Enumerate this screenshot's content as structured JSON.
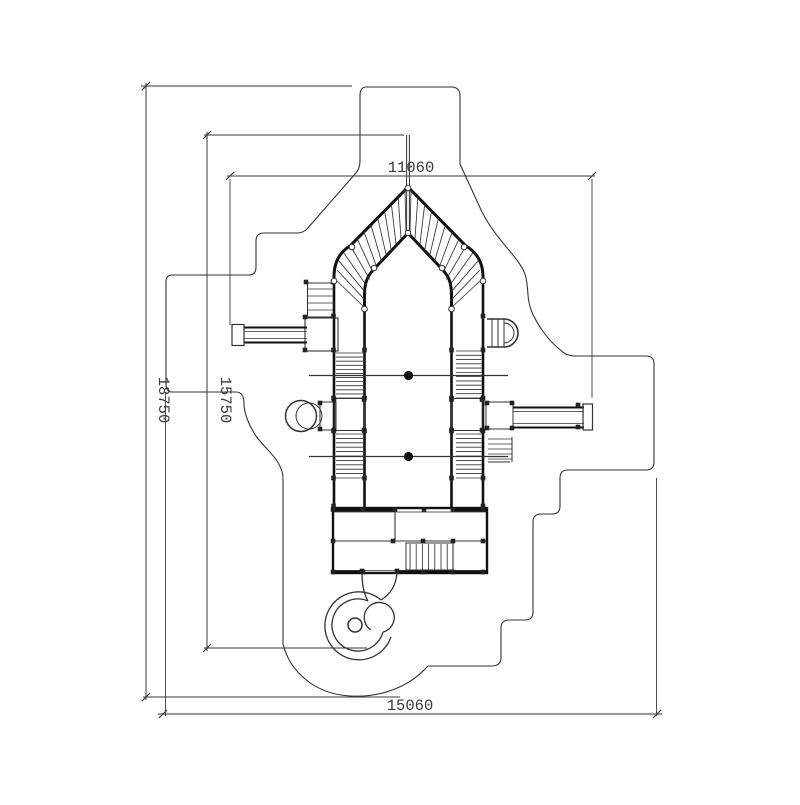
{
  "drawing": {
    "type": "playground-equipment-plan-view",
    "dimensions": {
      "top_width": "11060",
      "overall_height": "18750",
      "inner_height": "15750",
      "overall_width": "15060"
    },
    "colors": {
      "line": "#2a2a2a",
      "heavy_line": "#101010",
      "gray_line": "#9a9a9a",
      "dimension_text": "#3a3a3a",
      "background": "#ffffff"
    }
  }
}
